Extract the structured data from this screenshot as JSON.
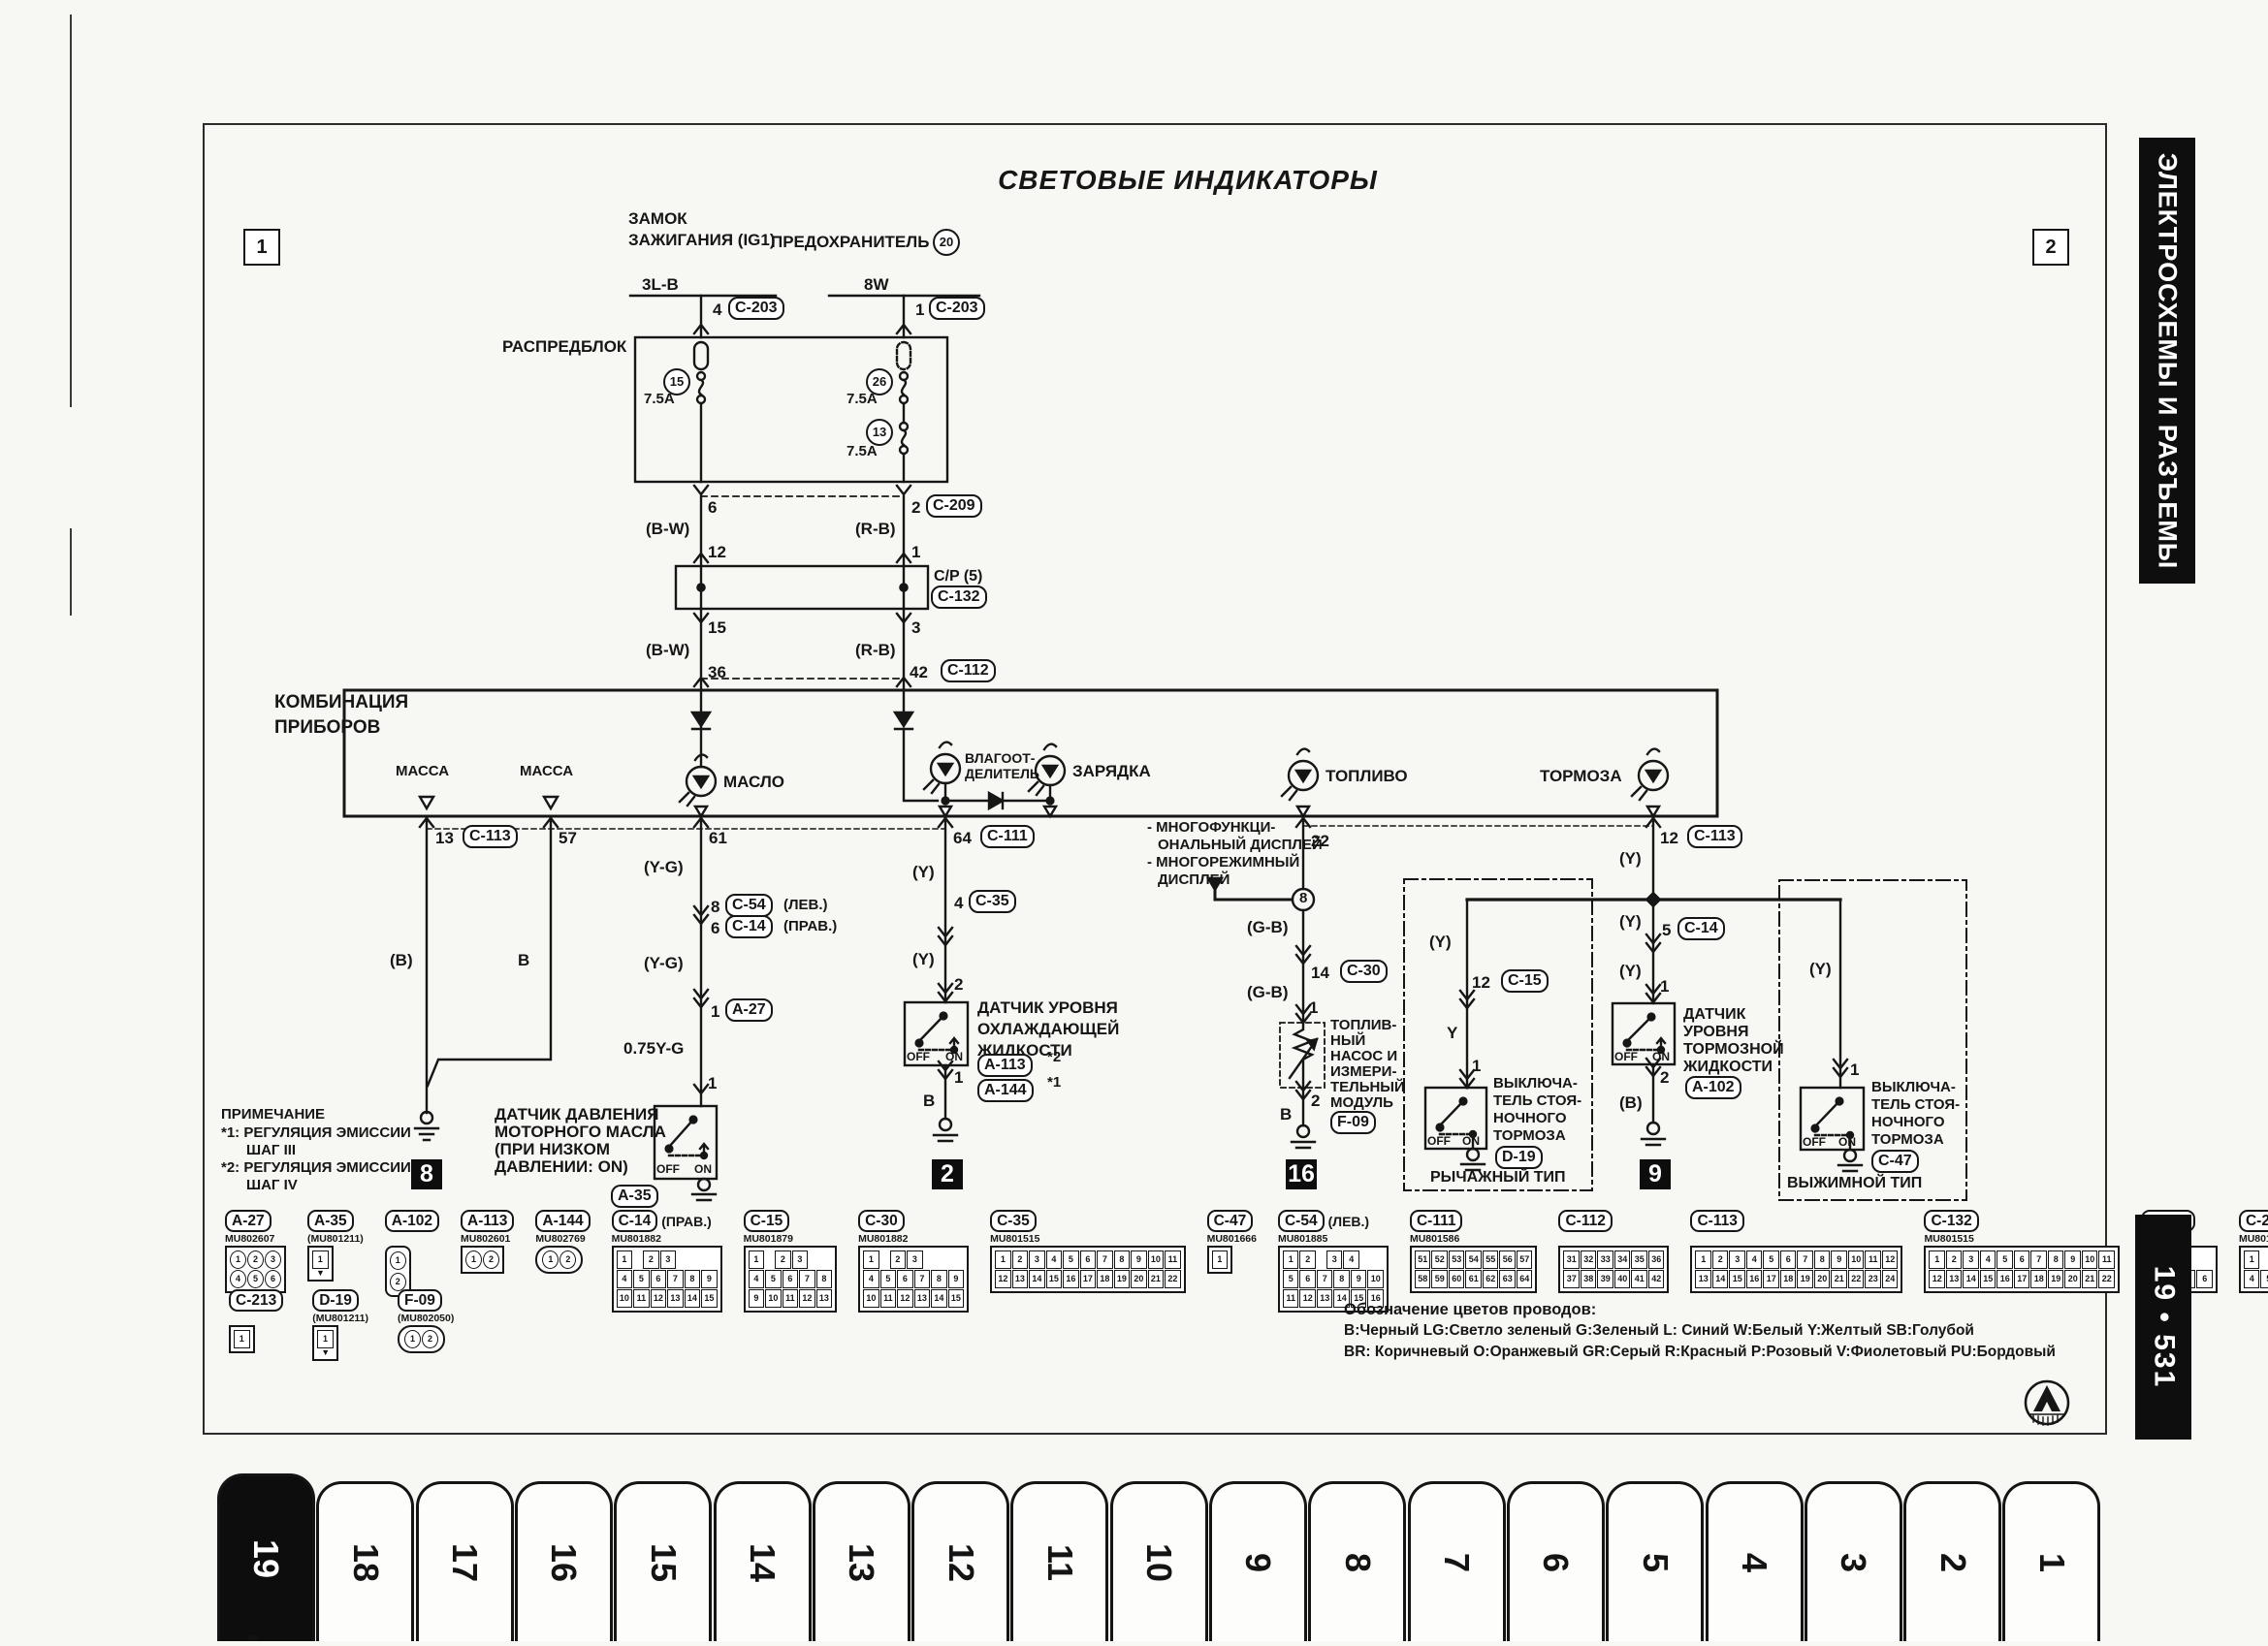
{
  "page": {
    "corner_left": "1",
    "corner_right": "2"
  },
  "title": "СВЕТОВЫЕ ИНДИКАТОРЫ",
  "sidebar": {
    "section": "ЭЛЕКТРОСХЕМЫ И РАЗЪЕМЫ",
    "page_ref": "19 • 531"
  },
  "tabs": [
    "19",
    "18",
    "17",
    "16",
    "15",
    "14",
    "13",
    "12",
    "11",
    "10",
    "9",
    "8",
    "7",
    "6",
    "5",
    "4",
    "3",
    "2",
    "1"
  ],
  "active_tab": "19",
  "power": {
    "ignition_l1": "ЗАМОК",
    "ignition_l2": "ЗАЖИГАНИЯ (IG1)",
    "fuse_label": "ПРЕДОХРАНИТЕЛЬ",
    "fuse_no": "20",
    "wire_l": "3L-B",
    "wire_r": "8W",
    "pin_l": "4",
    "conn_l": "C-203",
    "pin_r": "1",
    "conn_r": "C-203"
  },
  "dist_block": {
    "label": "РАСПРЕДБЛОК",
    "fuse1_no": "15",
    "fuse1_a": "7.5A",
    "fuse2_no": "26",
    "fuse2_a": "7.5A",
    "fuse3_no": "13",
    "fuse3_a": "7.5A"
  },
  "harness": {
    "pin6": "6",
    "pin2": "2",
    "c209": "C-209",
    "bw1": "(B-W)",
    "rb1": "(R-B)",
    "pin12": "12",
    "pin1": "1",
    "cp": "C/P (5)",
    "c132": "C-132",
    "pin15": "15",
    "pin3": "3",
    "bw2": "(B-W)",
    "rb2": "(R-B)",
    "pin36": "36",
    "pin42": "42",
    "c112": "C-112"
  },
  "cluster": {
    "name_l1": "КОМБИНАЦИЯ",
    "name_l2": "ПРИБОРОВ",
    "gnd1": "МАССА",
    "gnd2": "МАССА",
    "oil": "МАСЛО",
    "sep_l1": "ВЛАГООТ-",
    "sep_l2": "ДЕЛИТЕЛЬ",
    "charge": "ЗАРЯДКА",
    "fuel": "ТОПЛИВО",
    "brake": "ТОРМОЗА",
    "pin13": "13",
    "c113a": "C-113",
    "pin57": "57",
    "pin61": "61",
    "pin64": "64",
    "c111": "C-111",
    "pin22": "22",
    "pin12": "12",
    "c113b": "C-113"
  },
  "display_note": {
    "l1": "- МНОГОФУНКЦИ-",
    "l2": "ОНАЛЬНЫЙ ДИСПЛЕЙ",
    "l3": "- МНОГОРЕЖИМНЫЙ",
    "l4": "ДИСПЛЕЙ",
    "junction": "8"
  },
  "ground_branch": {
    "color1": "(B)",
    "color2": "B",
    "gnd_no": "8"
  },
  "oil_branch": {
    "yg1": "(Y-G)",
    "pin8": "8",
    "c54": "C-54",
    "lev": "(ЛЕВ.)",
    "pin6": "6",
    "c14": "C-14",
    "prav": "(ПРАВ.)",
    "yg2": "(Y-G)",
    "pin1": "1",
    "a27": "A-27",
    "wire": "0.75Y-G",
    "pin1b": "1",
    "name_l1": "ДАТЧИК ДАВЛЕНИЯ",
    "name_l2": "МОТОРНОГО МАСЛА",
    "name_l3": "(ПРИ НИЗКОМ",
    "name_l4": "ДАВЛЕНИИ: ON)",
    "id": "A-35",
    "off": "OFF",
    "on": "ON"
  },
  "coolant_branch": {
    "y1": "(Y)",
    "pin4": "4",
    "c35": "C-35",
    "y2": "(Y)",
    "pin2": "2",
    "name_l1": "ДАТЧИК УРОВНЯ",
    "name_l2": "ОХЛАЖДАЮЩЕЙ",
    "name_l3": "ЖИДКОСТИ",
    "id1": "A-113",
    "id1_ref": "*2",
    "id2": "A-144",
    "id2_ref": "*1",
    "pin1": "1",
    "b": "B",
    "gnd_no": "2",
    "off": "OFF",
    "on": "ON"
  },
  "fuel_branch": {
    "gb1": "(G-B)",
    "pin14": "14",
    "c30": "C-30",
    "gb2": "(G-B)",
    "pin1": "1",
    "name_l1": "ТОПЛИВ-",
    "name_l2": "НЫЙ",
    "name_l3": "НАСОС И",
    "name_l4": "ИЗМЕРИ-",
    "name_l5": "ТЕЛЬНЫЙ",
    "name_l6": "МОДУЛЬ",
    "id": "F-09",
    "pin2": "2",
    "b": "B",
    "gnd_no": "16"
  },
  "brake_fluid_branch": {
    "y0": "(Y)",
    "y1": "(Y)",
    "pin5": "5",
    "c14": "C-14",
    "y2": "(Y)",
    "pin1": "1",
    "name_l1": "ДАТЧИК",
    "name_l2": "УРОВНЯ",
    "name_l3": "ТОРМОЗНОЙ",
    "name_l4": "ЖИДКОСТИ",
    "pin2": "2",
    "id": "A-102",
    "b": "(B)",
    "gnd_no": "9",
    "off": "OFF",
    "on": "ON"
  },
  "lever_brake": {
    "y1": "(Y)",
    "pin12": "12",
    "c15": "C-15",
    "y": "Y",
    "pin1": "1",
    "name_l1": "ВЫКЛЮЧА-",
    "name_l2": "ТЕЛЬ СТОЯ-",
    "name_l3": "НОЧНОГО",
    "name_l4": "ТОРМОЗА",
    "id": "D-19",
    "type": "РЫЧАЖНЫЙ ТИП",
    "off": "OFF",
    "on": "ON"
  },
  "push_brake": {
    "y": "(Y)",
    "pin1": "1",
    "name_l1": "ВЫКЛЮЧА-",
    "name_l2": "ТЕЛЬ СТОЯ-",
    "name_l3": "НОЧНОГО",
    "name_l4": "ТОРМОЗА",
    "id": "C-47",
    "type": "ВЫЖИМНОЙ ТИП",
    "off": "OFF",
    "on": "ON"
  },
  "note": {
    "title": "ПРИМЕЧАНИЕ",
    "l1": "*1: РЕГУЛЯЦИЯ ЭМИССИИ",
    "l2": "ШАГ III",
    "l3": "*2: РЕГУЛЯЦИЯ ЭМИССИИ",
    "l4": "ШАГ IV"
  },
  "connectors_row1": [
    {
      "id": "A-27",
      "part": "MU802607",
      "note": "",
      "type": "grid-round",
      "rows": [
        [
          "1",
          "2",
          "3"
        ],
        [
          "4",
          "5",
          "6"
        ]
      ]
    },
    {
      "id": "A-35",
      "part": "(MU801211)",
      "note": "",
      "type": "single-arrow",
      "rows": [
        [
          "1"
        ]
      ]
    },
    {
      "id": "A-102",
      "part": "",
      "note": "",
      "type": "vpair",
      "rows": [
        [
          "1"
        ],
        [
          "2"
        ]
      ]
    },
    {
      "id": "A-113",
      "part": "MU802601",
      "note": "",
      "type": "grid-round",
      "rows": [
        [
          "1",
          "2"
        ]
      ]
    },
    {
      "id": "A-144",
      "part": "MU802769",
      "note": "",
      "type": "oval",
      "rows": [
        [
          "1",
          "2"
        ]
      ]
    },
    {
      "id": "C-14",
      "part": "MU801882",
      "note": "(ПРАВ.)",
      "type": "grid",
      "rows": [
        [
          "1",
          "",
          "2",
          "3"
        ],
        [
          "4",
          "5",
          "6",
          "7",
          "8",
          "9"
        ],
        [
          "10",
          "11",
          "12",
          "13",
          "14",
          "15"
        ]
      ]
    },
    {
      "id": "C-15",
      "part": "MU801879",
      "note": "",
      "type": "grid",
      "rows": [
        [
          "1",
          "",
          "2",
          "3"
        ],
        [
          "4",
          "5",
          "6",
          "7",
          "8"
        ],
        [
          "9",
          "10",
          "11",
          "12",
          "13"
        ]
      ]
    },
    {
      "id": "C-30",
      "part": "MU801882",
      "note": "",
      "type": "grid",
      "rows": [
        [
          "1",
          "",
          "2",
          "3"
        ],
        [
          "4",
          "5",
          "6",
          "7",
          "8",
          "9"
        ],
        [
          "10",
          "11",
          "12",
          "13",
          "14",
          "15"
        ]
      ]
    },
    {
      "id": "C-35",
      "part": "MU801515",
      "note": "",
      "type": "grid",
      "rows": [
        [
          "1",
          "2",
          "3",
          "4",
          "5",
          "6",
          "7",
          "8",
          "9",
          "10",
          "11"
        ],
        [
          "12",
          "13",
          "14",
          "15",
          "16",
          "17",
          "18",
          "19",
          "20",
          "21",
          "22"
        ]
      ]
    },
    {
      "id": "C-47",
      "part": "MU801666",
      "note": "",
      "type": "single",
      "rows": [
        [
          "1"
        ]
      ]
    },
    {
      "id": "C-54",
      "part": "MU801885",
      "note": "(ЛЕВ.)",
      "type": "grid",
      "rows": [
        [
          "1",
          "2",
          "",
          "3",
          "4"
        ],
        [
          "5",
          "6",
          "7",
          "8",
          "9",
          "10"
        ],
        [
          "11",
          "12",
          "13",
          "14",
          "15",
          "16"
        ]
      ]
    },
    {
      "id": "C-111",
      "part": "MU801586",
      "note": "",
      "type": "grid",
      "rows": [
        [
          "51",
          "52",
          "53",
          "54",
          "55",
          "56",
          "57"
        ],
        [
          "58",
          "59",
          "60",
          "61",
          "62",
          "63",
          "64"
        ]
      ]
    },
    {
      "id": "C-112",
      "part": "",
      "note": "",
      "type": "grid",
      "rows": [
        [
          "31",
          "32",
          "33",
          "34",
          "35",
          "36"
        ],
        [
          "37",
          "38",
          "39",
          "40",
          "41",
          "42"
        ]
      ]
    },
    {
      "id": "C-113",
      "part": "",
      "note": "",
      "type": "grid",
      "rows": [
        [
          "1",
          "2",
          "3",
          "4",
          "5",
          "6",
          "7",
          "8",
          "9",
          "10",
          "11",
          "12"
        ],
        [
          "13",
          "14",
          "15",
          "16",
          "17",
          "18",
          "19",
          "20",
          "21",
          "22",
          "23",
          "24"
        ]
      ]
    },
    {
      "id": "C-132",
      "part": "MU801515",
      "note": "",
      "type": "grid",
      "rows": [
        [
          "1",
          "2",
          "3",
          "4",
          "5",
          "6",
          "7",
          "8",
          "9",
          "10",
          "11"
        ],
        [
          "12",
          "13",
          "14",
          "15",
          "16",
          "17",
          "18",
          "19",
          "20",
          "21",
          "22"
        ]
      ]
    },
    {
      "id": "C-207",
      "part": "MU801331",
      "note": "",
      "type": "grid",
      "rows": [
        [
          "1",
          "",
          "2"
        ],
        [
          "3",
          "4",
          "5",
          "6"
        ]
      ]
    },
    {
      "id": "C-209",
      "part": "MU801839",
      "note": "",
      "type": "grid",
      "rows": [
        [
          "1",
          "",
          "2",
          "3"
        ],
        [
          "4",
          "5",
          "6",
          "7",
          "8"
        ]
      ]
    }
  ],
  "connectors_row2": [
    {
      "id": "C-213",
      "part": "",
      "note": "",
      "type": "single",
      "rows": [
        [
          "1"
        ]
      ]
    },
    {
      "id": "D-19",
      "part": "(MU801211)",
      "note": "",
      "type": "single-arrow",
      "rows": [
        [
          "1"
        ]
      ]
    },
    {
      "id": "F-09",
      "part": "(MU802050)",
      "note": "",
      "type": "oval",
      "rows": [
        [
          "1",
          "2"
        ]
      ]
    }
  ],
  "legend": {
    "title": "Обозначение цветов проводов:",
    "l1": "B:Черный LG:Светло зеленый G:Зеленый L: Синий W:Белый Y:Желтый SB:Голубой",
    "l2": "BR: Коричневый O:Оранжевый GR:Серый R:Красный P:Розовый V:Фиолетовый PU:Бордовый"
  }
}
